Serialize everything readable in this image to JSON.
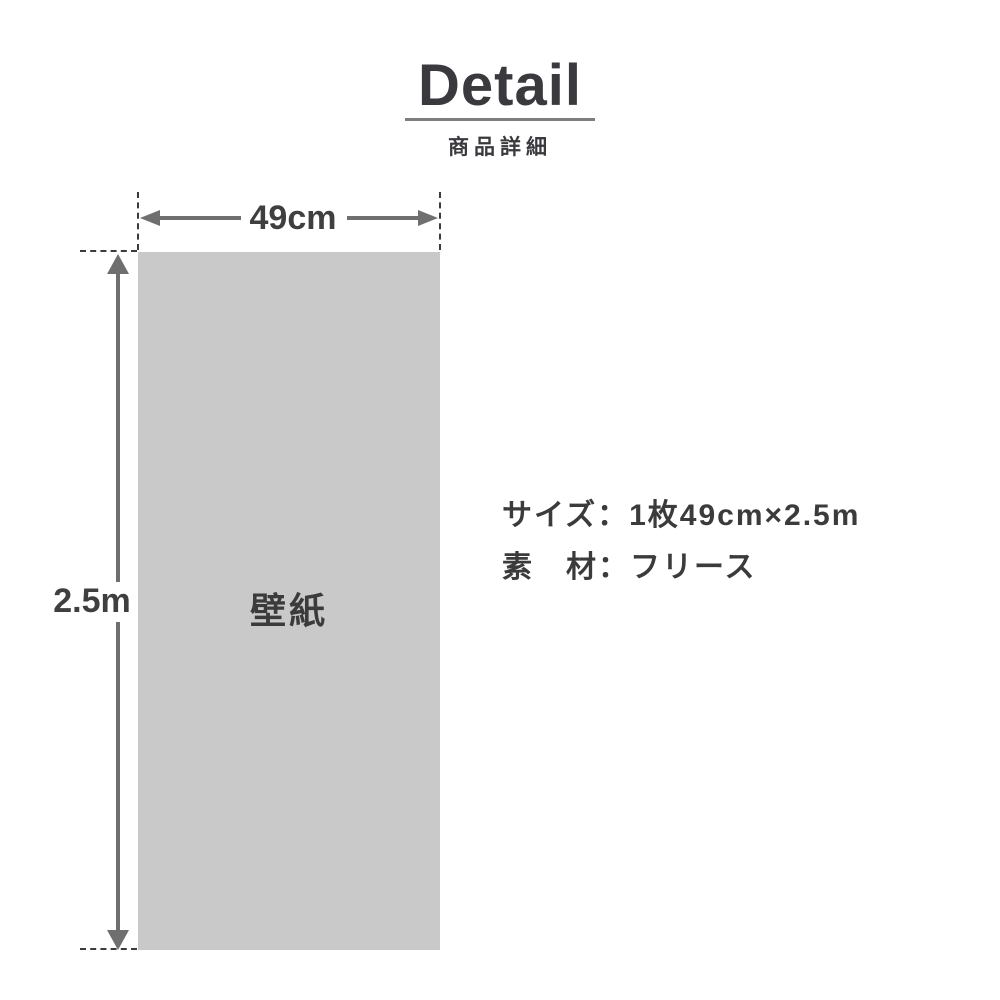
{
  "header": {
    "title": "Detail",
    "subtitle": "商品詳細"
  },
  "diagram": {
    "sheet_label": "壁紙",
    "width_label": "49cm",
    "height_label": "2.5m"
  },
  "specs": {
    "size_line": "サイズ：1枚49cm×2.5m",
    "material_line": "素　材：フリース"
  },
  "colors": {
    "background": "#ffffff",
    "sheet_fill": "#c9c9c9",
    "arrow_gray": "#6f6f6f",
    "underline_gray": "#7e7e7e",
    "dash_dark": "#3b3b3b",
    "text_dark": "#3a3a3e"
  }
}
